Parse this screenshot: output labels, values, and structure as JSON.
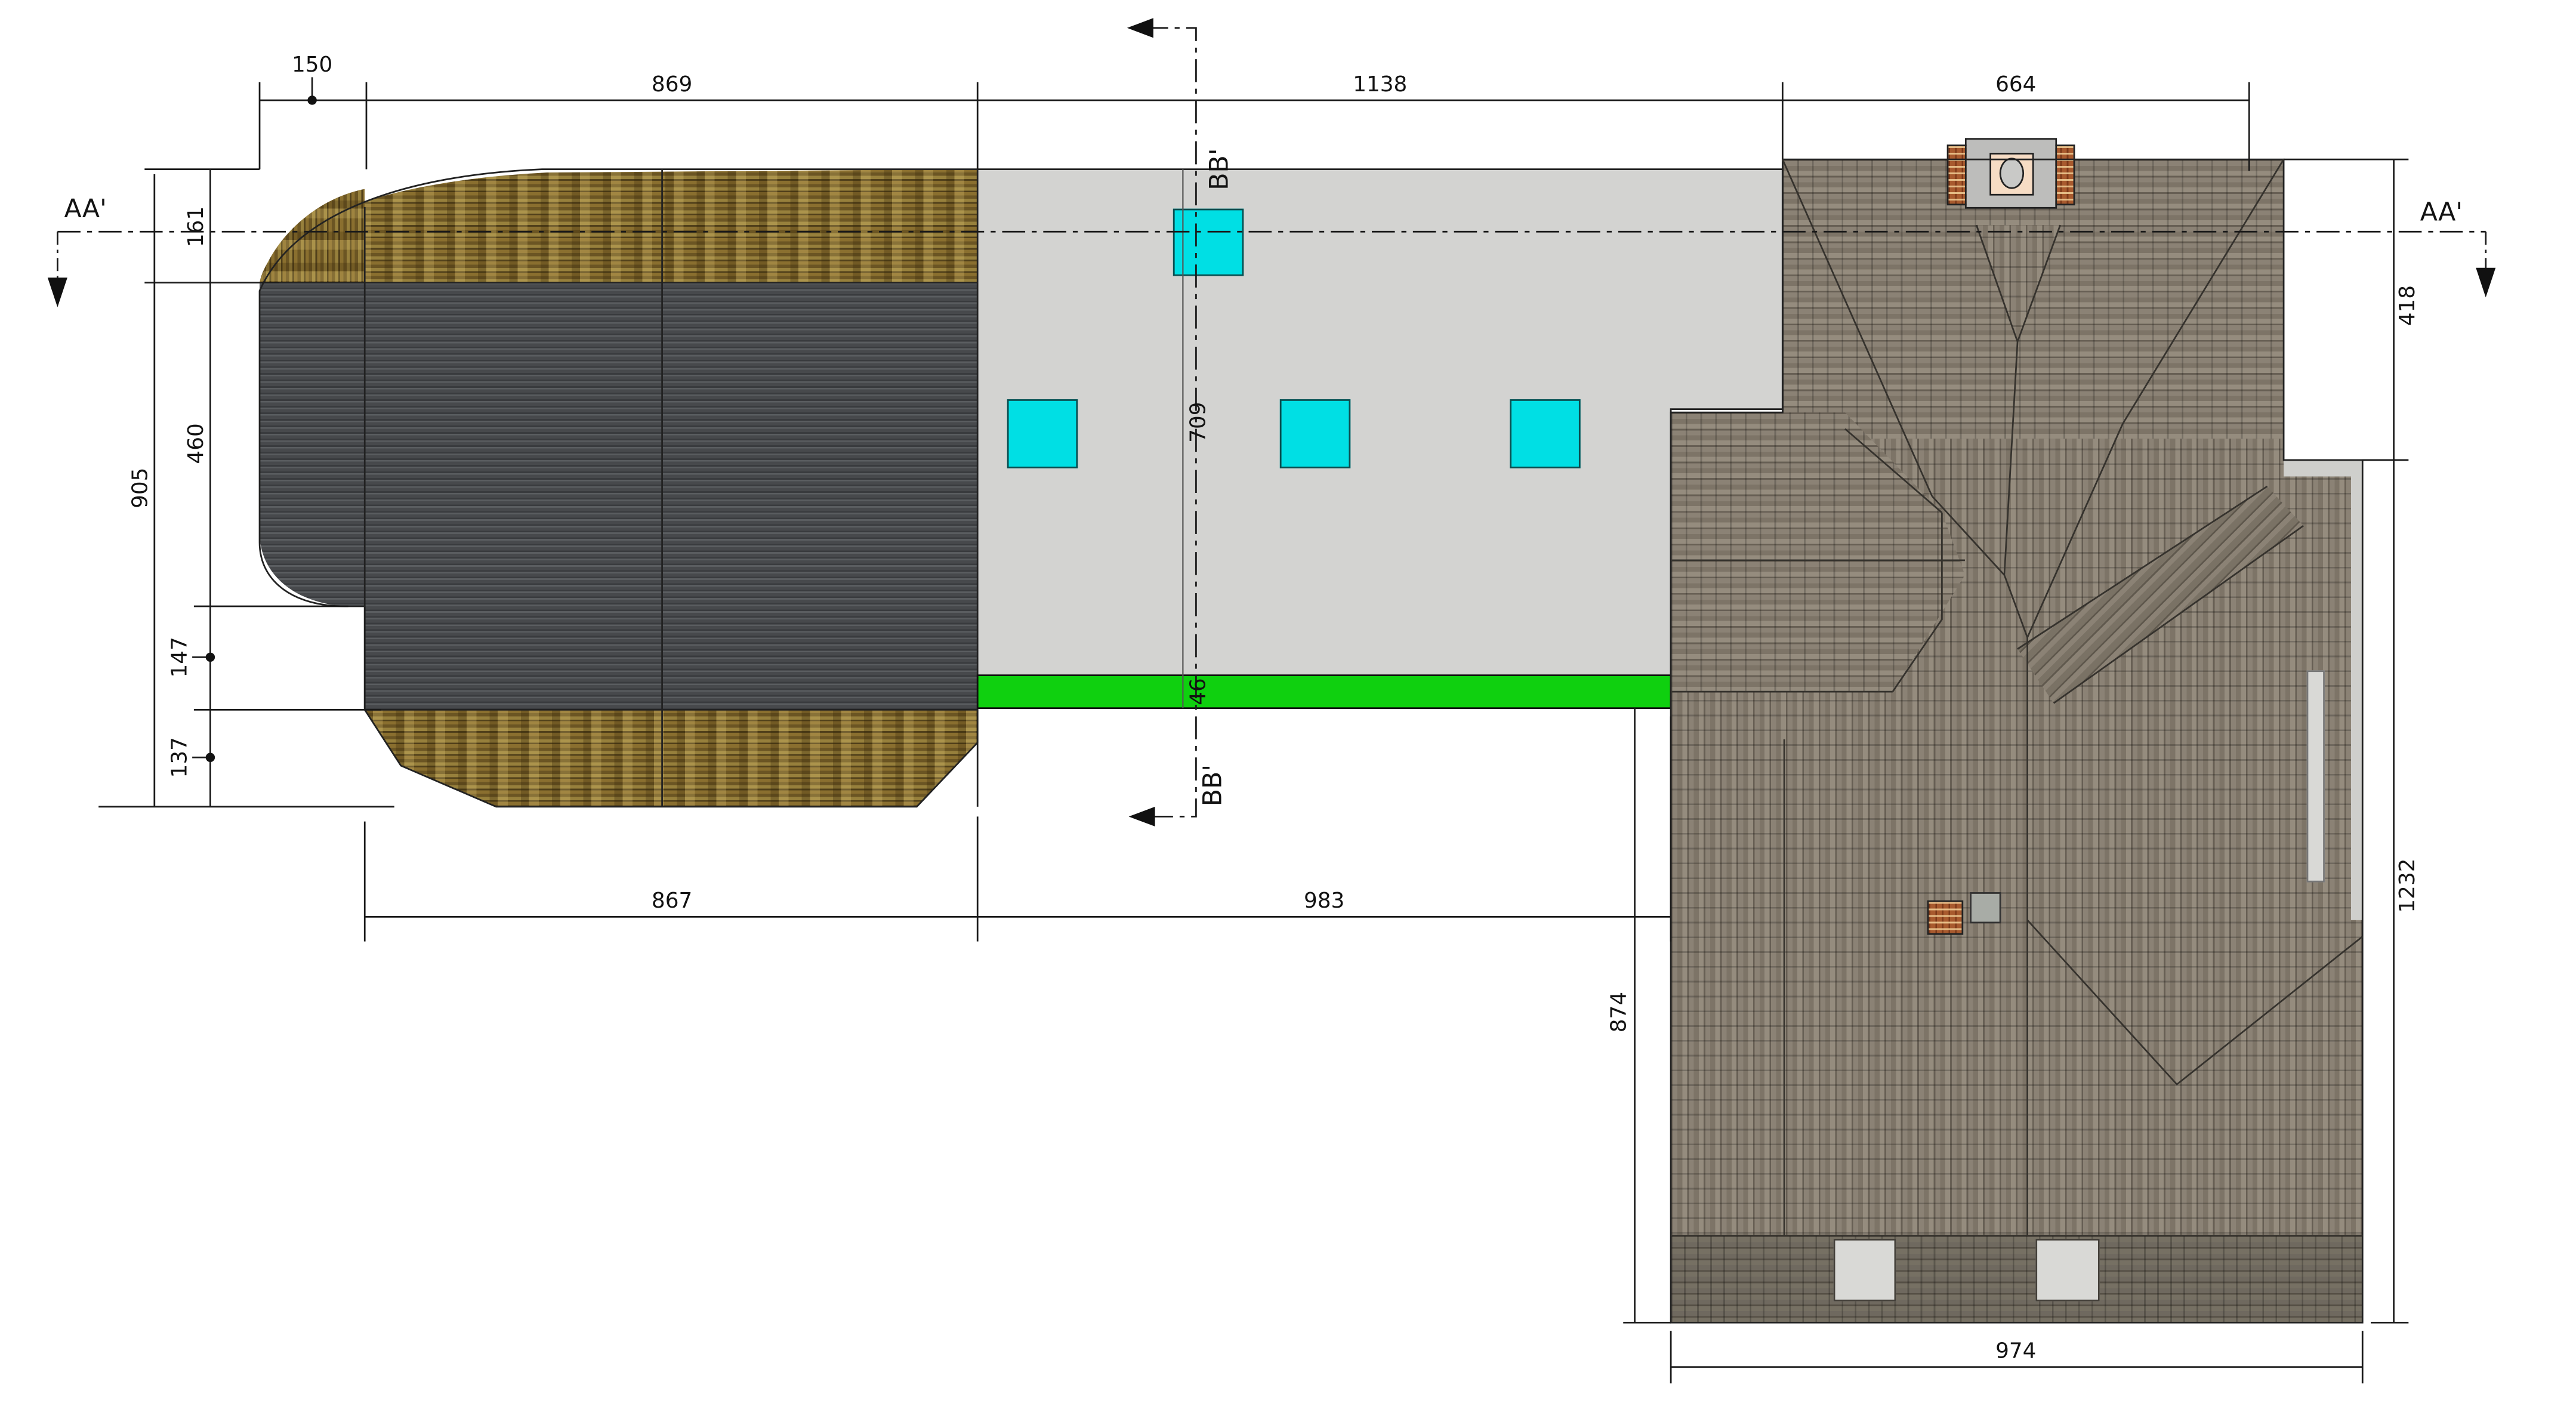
{
  "drawing_title": "roof-plan-drawing",
  "sections": {
    "aa": "AA'",
    "bb": "BB'"
  },
  "dims": {
    "d150": "150",
    "d869": "869",
    "d1138": "1138",
    "d664": "664",
    "d161": "161",
    "d460": "460",
    "d147": "147",
    "d137": "137",
    "d905": "905",
    "d418": "418",
    "d1232": "1232",
    "d867": "867",
    "d983": "983",
    "d974": "974",
    "d874": "874",
    "d709": "709",
    "d46": "46"
  },
  "colors": {
    "flat_roof": "#d3d3d1",
    "skylight": "#00dfe4",
    "lawn": "#0fd00f",
    "corrugated": "#47494c",
    "thatch": "#8a6f2f",
    "shingle": "#8b8275",
    "shingle_dark": "#6f695f",
    "brick": "#a85a2e",
    "chimney_cap": "#bdbdbb",
    "chimney_inner": "#f6dcc4",
    "line": "#1a1a1a"
  }
}
